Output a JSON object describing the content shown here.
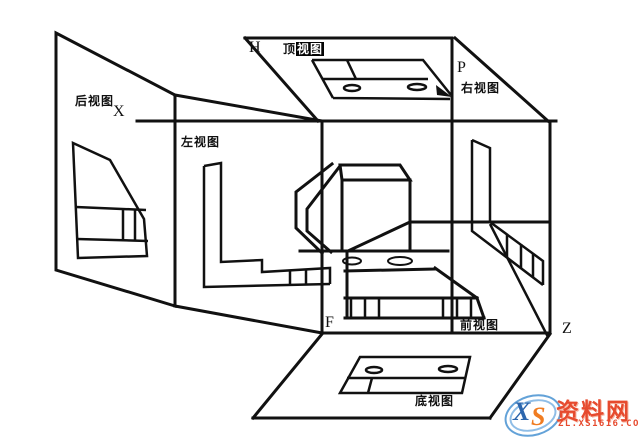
{
  "diagram": {
    "plane_h": "H",
    "plane_p": "P",
    "plane_f": "F",
    "axis_x": "X",
    "axis_z": "Z",
    "view_rear": "后视图",
    "view_left": "左视图",
    "view_top_pre": "顶",
    "view_top_hl": "视图",
    "view_right": "右视图",
    "view_front": "前视图",
    "view_bottom": "底视图"
  },
  "watermark": {
    "logo_x": "X",
    "logo_s": "S",
    "site_name": "资料网",
    "site_url": "ZL.XS1616.COM"
  },
  "colors": {
    "line": "#111111",
    "background": "#ffffff",
    "watermark_red": "#e64a2e",
    "watermark_blue": "#2c66ad",
    "watermark_orange": "#f07c21"
  }
}
